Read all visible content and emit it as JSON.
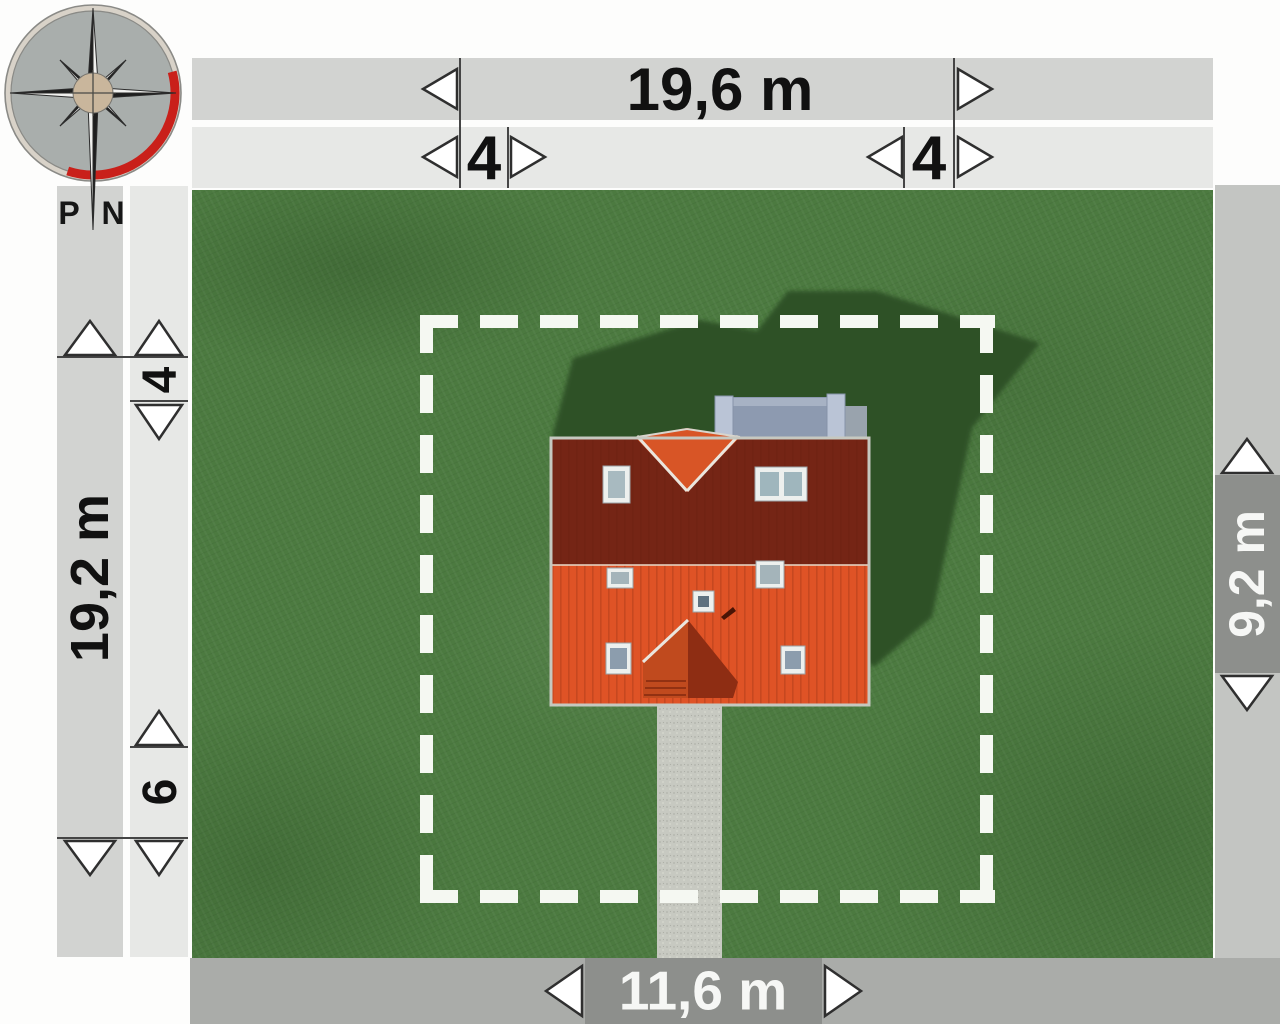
{
  "title": "House site plan with setback dimensions",
  "compass": {
    "letter_west": "P",
    "letter_north": "N"
  },
  "dimensions": {
    "plot_width": "19,6 m",
    "setback_top_left": "4",
    "setback_top_right": "4",
    "plot_depth": "19,2 m",
    "setback_left_top": "4",
    "setback_left_bottom": "6",
    "house_depth": "9,2 m",
    "house_width": "11,6 m"
  },
  "colors": {
    "grass": "#4c7a40",
    "grass_shadow": "#2d5126",
    "roof_north": "#752515",
    "roof_south": "#df5326",
    "roof_gable": "#d85526",
    "dormer_left": "#c04a1e",
    "dormer_right": "#8e2d13",
    "terrace": "#8d9ab0",
    "terrace_post": "#bac4d6",
    "path": "#c7c9c1",
    "bar_medium": "#d2d3d1",
    "bar_light": "#e7e8e6",
    "bar_right": "#c3c5c2",
    "bar_bottom": "#aaaca9",
    "seg_dark": "#8d8f8c",
    "line_dark": "#454545",
    "arrow_fill": "#ffffff",
    "arrow_stroke": "#2f2f2f",
    "dash_white": "#f5f8f2",
    "compass_red": "#c9201a",
    "text_dark": "#111111",
    "text_light": "#f6f7f5"
  }
}
